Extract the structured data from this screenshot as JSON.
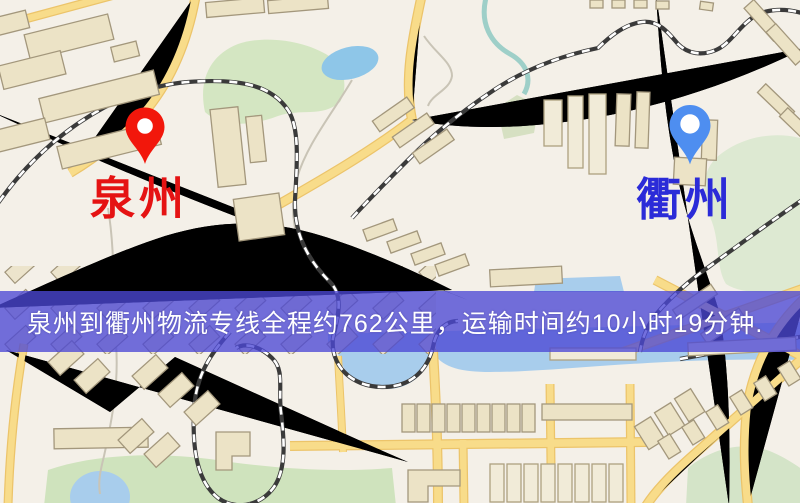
{
  "banner": {
    "text": "泉州到衢州物流专线全程约762公里，运输时间约10小时19分钟.",
    "background_color": "rgba(76,72,213,0.78)",
    "text_color": "#ffffff"
  },
  "route": {
    "origin": "泉州",
    "destination": "衢州",
    "distance_text": "约762公里",
    "duration_text": "约10小时19分钟"
  },
  "markers": [
    {
      "name": "origin",
      "label": "泉州",
      "pin_color": "#f2170b",
      "label_color": "#e51313"
    },
    {
      "name": "destination",
      "label": "衢州",
      "pin_color": "#4e8ef0",
      "label_color": "#2b2bd8"
    }
  ],
  "map": {
    "background_color": "#f4f0e8",
    "road_color": "#f7d26e",
    "water_color": "#a8cdec",
    "park_color": "#d4e6c2",
    "building_color": "#ece3c6",
    "railway_color": "#3a3a3a"
  }
}
